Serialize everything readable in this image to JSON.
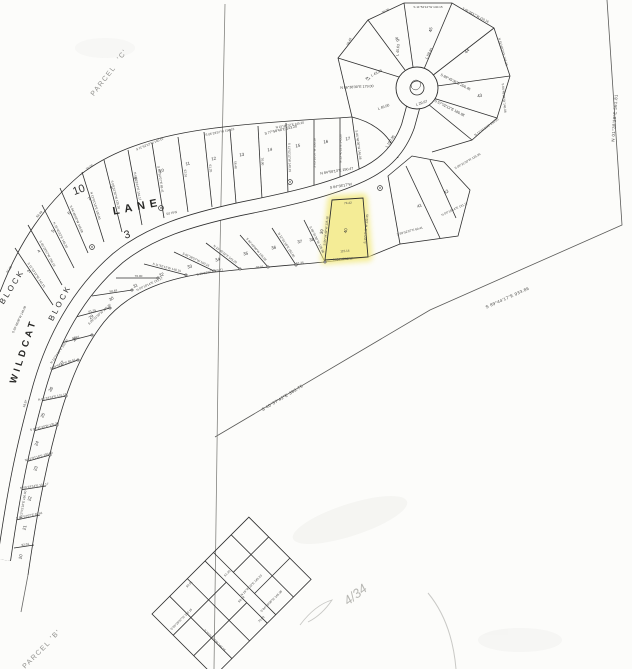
{
  "labels": {
    "parcel_c_word": "PARCEL",
    "parcel_c_id": "'C'",
    "parcel_b_word": "PARCEL",
    "parcel_b_id": "'B'",
    "street_wildcat": "WILDCAT",
    "street_lane": "LANE",
    "row": "50' R/W",
    "block_outer_word": "BLOCK",
    "block_outer_num": "10",
    "block_inner_word": "BLOCK",
    "block_inner_num": "3",
    "handwritten_note": "4/34",
    "tip_len": "18.97"
  },
  "boundary_bearings": {
    "east": "N 01°38'28\"E  561.81",
    "southeast": "S 89°44'17\"E  933.86",
    "southwest": "S 40°57'42\"E  363.75"
  },
  "highlight_lot": {
    "number": "40",
    "top_len": "74.42",
    "bottom_len": "115.14",
    "bottom_bearing": "N 84°48'08\"W",
    "left_bearing": "S 05°34'49\"W  135.36",
    "right_bearing": "S 15°13'49\"W  132.35"
  },
  "edge_labels": [
    {
      "t": "S 77°58'48\"E  143.20",
      "x": 281,
      "y": 131,
      "r": -13
    },
    {
      "t": "N 84°58'13\"E  150.47",
      "x": 337,
      "y": 172,
      "r": -9
    },
    {
      "t": "S 84°38'17\"W",
      "x": 341,
      "y": 187,
      "r": -9
    },
    {
      "t": "N 86°38'30\"E  179.00",
      "x": 357,
      "y": 88,
      "r": -3
    },
    {
      "t": "L 45.63",
      "x": 399,
      "y": 50,
      "r": -85
    },
    {
      "t": "L 43.43",
      "x": 377,
      "y": 74,
      "r": -28
    },
    {
      "t": "L 45.00",
      "x": 384,
      "y": 108,
      "r": -20
    },
    {
      "t": "L 29.67",
      "x": 422,
      "y": 104,
      "r": -18
    },
    {
      "t": "L 59.45",
      "x": 430,
      "y": 54,
      "r": -62
    },
    {
      "t": "S 89°45'36\"E  200.46",
      "x": 455,
      "y": 83,
      "r": 27
    },
    {
      "t": "S 57°02'13\"E  180.98",
      "x": 449,
      "y": 109,
      "r": 27
    },
    {
      "t": "L 150.35",
      "x": 391,
      "y": 142,
      "r": -57
    }
  ],
  "micro_bearings": [
    "S 11°52'12\"W  140.15",
    "S 05°28'57\"W  150.16",
    "N 15°40'22\"E  145.20",
    "S 84°48'08\"W  146.08",
    "N 12°01'18\"E  150.00",
    "S 09°31'30\"W  135.36",
    "N 05°18'14\"E  131.17",
    "S 89°52'07\"E  69.41",
    "92.01",
    "61.35",
    "58.48",
    "70.00"
  ],
  "lot_numbers_outer": [
    {
      "n": "3",
      "x": 30,
      "y": 272,
      "r": -62
    },
    {
      "n": "4",
      "x": 40,
      "y": 252,
      "r": -58
    },
    {
      "n": "5",
      "x": 54,
      "y": 232,
      "r": -52
    },
    {
      "n": "6",
      "x": 70,
      "y": 214,
      "r": -46
    },
    {
      "n": "7",
      "x": 90,
      "y": 200,
      "r": -38
    },
    {
      "n": "8",
      "x": 112,
      "y": 189,
      "r": -30
    },
    {
      "n": "9",
      "x": 136,
      "y": 180,
      "r": -24
    },
    {
      "n": "10",
      "x": 162,
      "y": 172,
      "r": -18
    },
    {
      "n": "11",
      "x": 188,
      "y": 165,
      "r": -14
    },
    {
      "n": "12",
      "x": 214,
      "y": 160,
      "r": -12
    },
    {
      "n": "13",
      "x": 242,
      "y": 156,
      "r": -10
    },
    {
      "n": "14",
      "x": 270,
      "y": 151,
      "r": -9
    },
    {
      "n": "15",
      "x": 298,
      "y": 147,
      "r": -8
    },
    {
      "n": "16",
      "x": 326,
      "y": 143,
      "r": -8
    },
    {
      "n": "17",
      "x": 348,
      "y": 140,
      "r": -8
    }
  ],
  "lot_numbers_inner": [
    {
      "n": "20",
      "x": 22,
      "y": 557,
      "r": -78
    },
    {
      "n": "21",
      "x": 26,
      "y": 528,
      "r": -76
    },
    {
      "n": "22",
      "x": 31,
      "y": 499,
      "r": -74
    },
    {
      "n": "23",
      "x": 37,
      "y": 469,
      "r": -72
    },
    {
      "n": "24",
      "x": 38,
      "y": 444,
      "r": -68
    },
    {
      "n": "25",
      "x": 44,
      "y": 416,
      "r": -64
    },
    {
      "n": "26",
      "x": 52,
      "y": 390,
      "r": -58
    },
    {
      "n": "27",
      "x": 63,
      "y": 364,
      "r": -52
    },
    {
      "n": "28",
      "x": 76,
      "y": 340,
      "r": -46
    },
    {
      "n": "29",
      "x": 92,
      "y": 318,
      "r": -40
    },
    {
      "n": "30",
      "x": 112,
      "y": 300,
      "r": -32
    },
    {
      "n": "31",
      "x": 136,
      "y": 287,
      "r": -26
    },
    {
      "n": "32",
      "x": 162,
      "y": 276,
      "r": -20
    },
    {
      "n": "33",
      "x": 190,
      "y": 268,
      "r": -16
    },
    {
      "n": "34",
      "x": 218,
      "y": 261,
      "r": -14
    },
    {
      "n": "35",
      "x": 246,
      "y": 255,
      "r": -12
    },
    {
      "n": "36",
      "x": 274,
      "y": 249,
      "r": -11
    },
    {
      "n": "37",
      "x": 300,
      "y": 243,
      "r": -10
    },
    {
      "n": "38",
      "x": 312,
      "y": 241,
      "r": -10
    },
    {
      "n": "39",
      "x": 323,
      "y": 232,
      "r": -78
    }
  ],
  "lot_numbers_fan": [
    {
      "n": "41",
      "x": 420,
      "y": 207,
      "r": -25
    },
    {
      "n": "42",
      "x": 447,
      "y": 193,
      "r": -35
    },
    {
      "n": "43",
      "x": 480,
      "y": 97,
      "r": -15
    },
    {
      "n": "44",
      "x": 468,
      "y": 52,
      "r": -45
    },
    {
      "n": "45",
      "x": 432,
      "y": 30,
      "r": -80
    },
    {
      "n": "46",
      "x": 396,
      "y": 40,
      "r": 60
    },
    {
      "n": "47",
      "x": 367,
      "y": 80,
      "r": 30
    }
  ],
  "colors": {
    "highlight": "#f3e97e",
    "ink": "#2f2f2f",
    "paper": "#fcfcfa",
    "faint": "#9a9a97"
  }
}
